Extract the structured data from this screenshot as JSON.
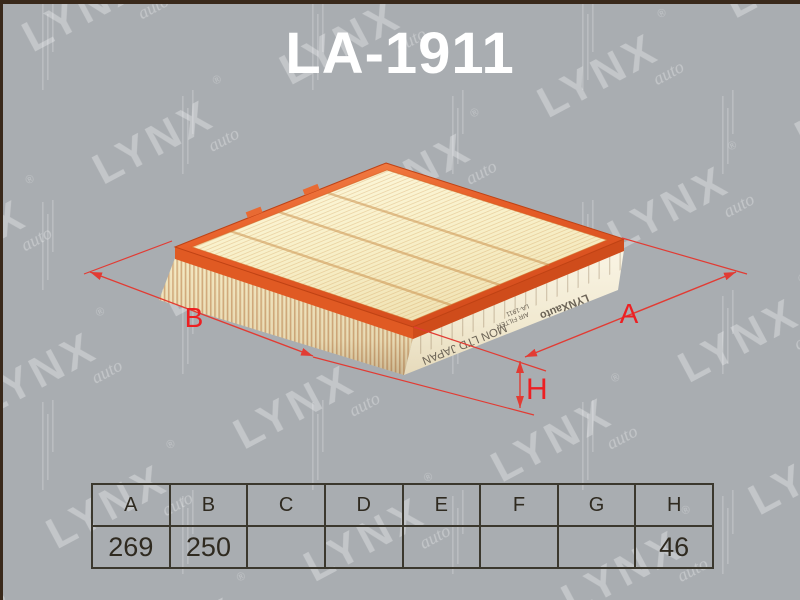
{
  "page": {
    "title": "LA-1911"
  },
  "watermark": {
    "brand": "LYNX",
    "sub": "auto",
    "registered": "®"
  },
  "dimensions": {
    "a_label": "A",
    "b_label": "B",
    "h_label": "H"
  },
  "side_print": {
    "brand": "LYNXauto",
    "part_number": "LA-1911",
    "product_type": "AIR FILTER",
    "origin": "MON LTD JAPAN"
  },
  "spec_table": {
    "headers": [
      "A",
      "B",
      "C",
      "D",
      "E",
      "F",
      "G",
      "H"
    ],
    "values": [
      "269",
      "250",
      "",
      "",
      "",
      "",
      "",
      "46"
    ]
  },
  "colors": {
    "background": "#a9adb1",
    "dimension_red": "#e23b33",
    "label_red": "#ed1f22",
    "rim_orange": "#e65c26",
    "media_cream": "#f8f2d0",
    "frame_border": "#39291b",
    "table_border": "#3b382e",
    "title_white": "#ffffff"
  }
}
